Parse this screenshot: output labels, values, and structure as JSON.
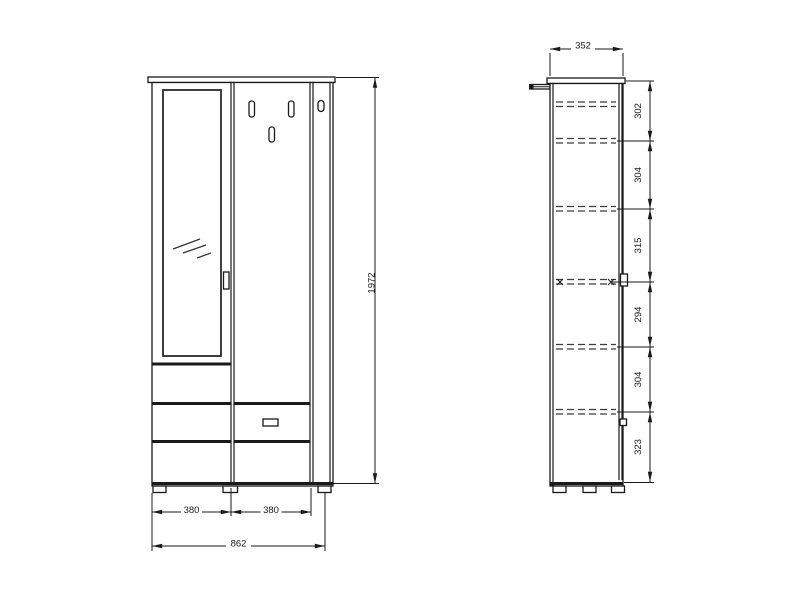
{
  "drawing": {
    "type": "furniture-technical-drawing",
    "colors": {
      "line": "#1a1a1a",
      "background": "#ffffff"
    },
    "front_view": {
      "total_height": "1972",
      "left_section_width": "380",
      "right_section_width": "380",
      "total_width": "862"
    },
    "side_view": {
      "depth": "352",
      "shelf_spacings": [
        "302",
        "304",
        "315",
        "294",
        "304",
        "323"
      ]
    },
    "icons": {
      "mirror_reflection": "diagonal-hatch",
      "coat_hook": "vertical-slot",
      "wall_bracket": "side-bracket",
      "hidden_shelf": "dashed-line"
    }
  }
}
